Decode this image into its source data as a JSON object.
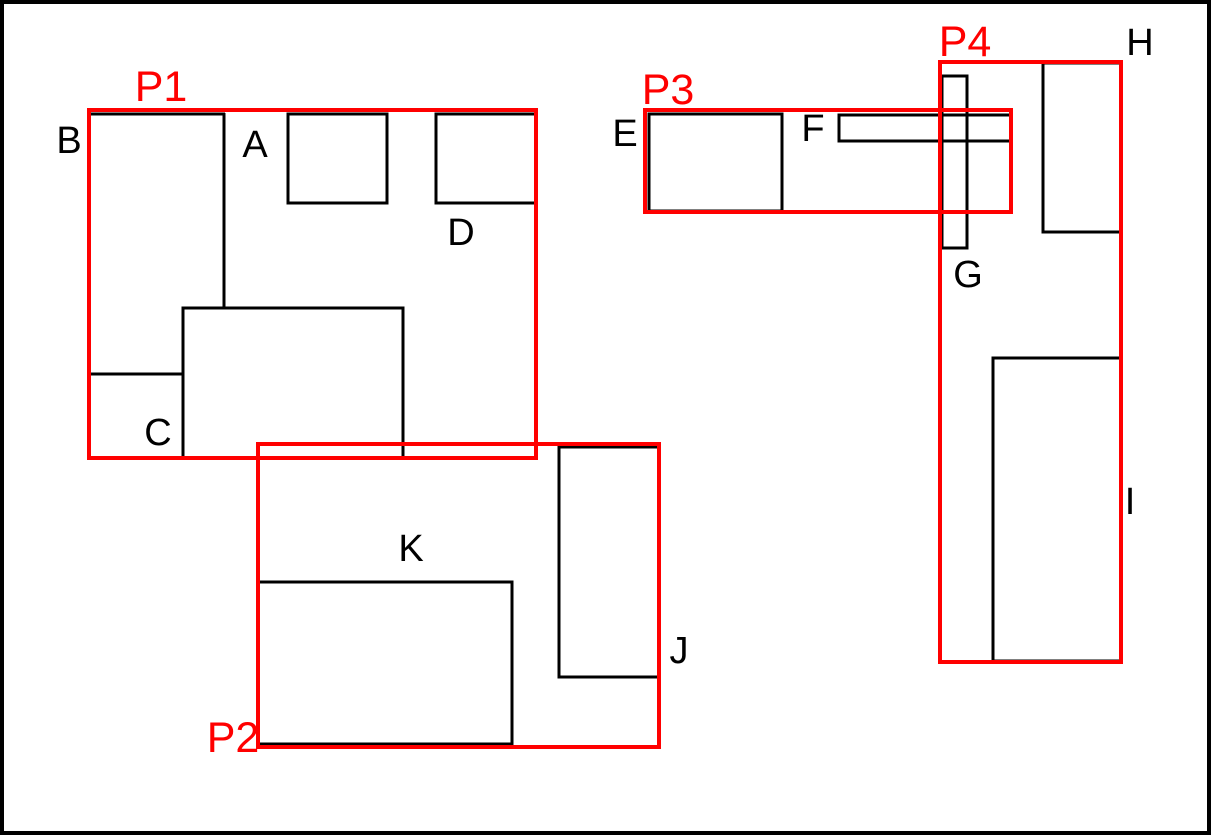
{
  "colors": {
    "outline": "#000000",
    "highlight": "#ff0000",
    "background": "#ffffff"
  },
  "labels": {
    "items": {
      "a": "A",
      "b": "B",
      "c": "C",
      "d": "D",
      "e": "E",
      "f": "F",
      "g": "G",
      "h": "H",
      "i": "I",
      "j": "J",
      "k": "K"
    },
    "regions": {
      "p1": "P1",
      "p2": "P2",
      "p3": "P3",
      "p4": "P4"
    }
  }
}
